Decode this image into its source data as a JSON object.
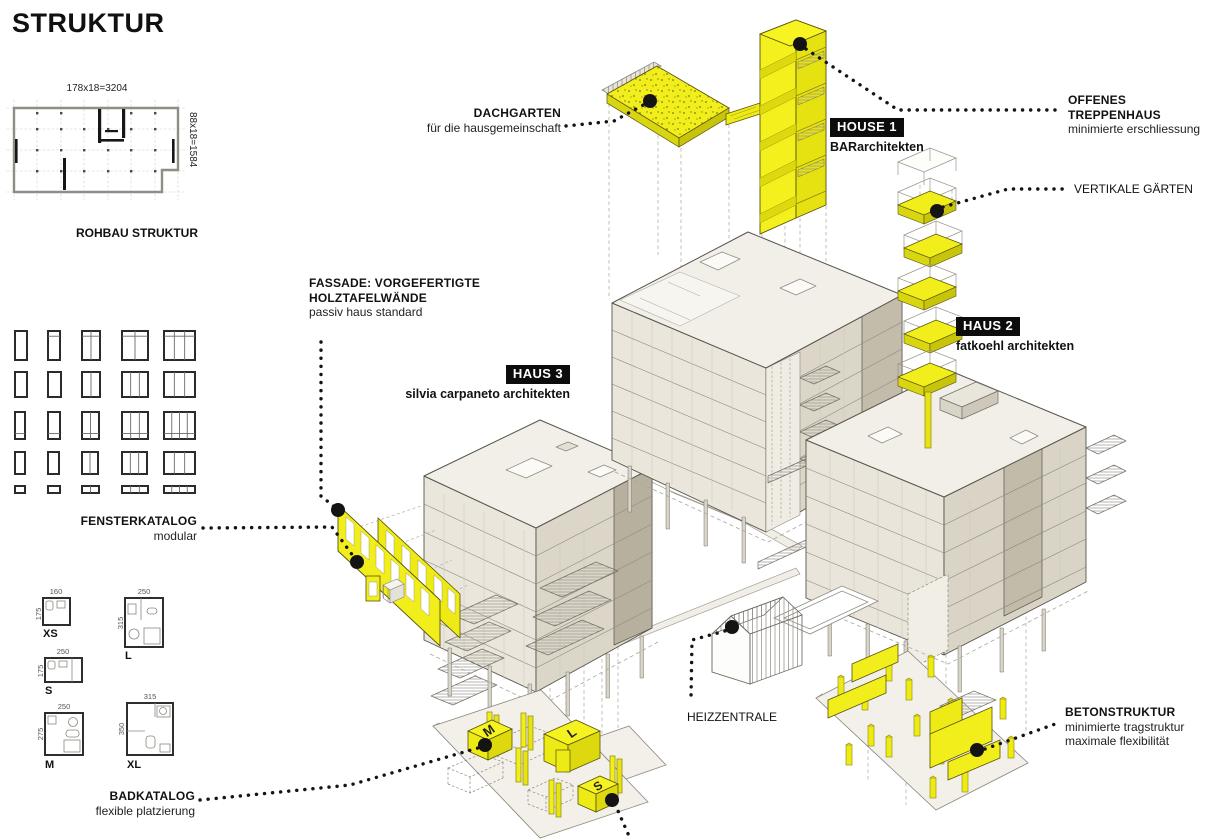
{
  "title": "STRUKTUR",
  "colors": {
    "accent_yellow": "#f2ee1c",
    "accent_yellow_dark": "#d9d510",
    "roof_light": "#f1efe7",
    "face_light": "#eae6db",
    "face_mid": "#dbd6c8",
    "face_dark": "#bdb5a4",
    "line_dark": "#56544c",
    "leader_black": "#141414"
  },
  "rohbau": {
    "label": "ROHBAU STRUKTUR",
    "dim_horizontal": "178x18=3204",
    "dim_vertical": "88x18=1584"
  },
  "fensterkatalog": {
    "label": "FENSTERKATALOG",
    "sublabel": "modular",
    "grid": {
      "rows": [
        {
          "y": 331,
          "h": 29,
          "cells": [
            {
              "x": 15,
              "w": 12
            },
            {
              "x": 48,
              "w": 12,
              "tr": "top"
            },
            {
              "x": 82,
              "w": 18,
              "m": 1,
              "tr": "top"
            },
            {
              "x": 122,
              "w": 26,
              "m": 1,
              "tr": "top"
            },
            {
              "x": 164,
              "w": 31,
              "m": 2,
              "tr": "top"
            }
          ]
        },
        {
          "y": 372,
          "h": 25,
          "cells": [
            {
              "x": 15,
              "w": 12
            },
            {
              "x": 48,
              "w": 13
            },
            {
              "x": 82,
              "w": 18,
              "m": 1
            },
            {
              "x": 122,
              "w": 26,
              "m": 2
            },
            {
              "x": 164,
              "w": 31,
              "m": 2
            }
          ]
        },
        {
          "y": 412,
          "h": 27,
          "cells": [
            {
              "x": 15,
              "w": 10,
              "tr": "bottom"
            },
            {
              "x": 48,
              "w": 12,
              "tr": "bottom"
            },
            {
              "x": 82,
              "w": 17,
              "m": 1,
              "tr": "bottom"
            },
            {
              "x": 122,
              "w": 26,
              "m": 2,
              "tr": "bottom"
            },
            {
              "x": 164,
              "w": 31,
              "m": 3,
              "tr": "bottom"
            }
          ]
        },
        {
          "y": 452,
          "h": 22,
          "cells": [
            {
              "x": 15,
              "w": 10
            },
            {
              "x": 48,
              "w": 11
            },
            {
              "x": 82,
              "w": 16,
              "m": 1
            },
            {
              "x": 122,
              "w": 25,
              "m": 2
            },
            {
              "x": 164,
              "w": 31,
              "m": 2
            }
          ]
        },
        {
          "y": 486,
          "h": 7,
          "cells": [
            {
              "x": 15,
              "w": 10
            },
            {
              "x": 48,
              "w": 12
            },
            {
              "x": 82,
              "w": 17,
              "m": 1
            },
            {
              "x": 122,
              "w": 26,
              "m": 2
            },
            {
              "x": 164,
              "w": 31,
              "m": 3
            }
          ]
        }
      ]
    }
  },
  "badkatalog": {
    "label": "BADKATALOG",
    "sublabel": "flexible platzierung",
    "items": [
      {
        "name": "XS",
        "width": "160",
        "height": "175"
      },
      {
        "name": "S",
        "width": "250",
        "height": "175"
      },
      {
        "name": "M",
        "width": "250",
        "height": "275"
      },
      {
        "name": "L",
        "width": "250",
        "height": "315"
      },
      {
        "name": "XL",
        "width": "315",
        "height": "350"
      }
    ]
  },
  "modules": {
    "m": "M",
    "l": "L",
    "s": "S"
  },
  "buildings": {
    "house1": {
      "tag": "HOUSE 1",
      "architect": "BARarchitekten"
    },
    "haus2": {
      "tag": "HAUS 2",
      "architect": "fatkoehl architekten"
    },
    "haus3": {
      "tag": "HAUS 3",
      "architect": "silvia carpaneto architekten"
    }
  },
  "annotations": {
    "dachgarten": {
      "title": "DACHGARTEN",
      "subtitle": "für die hausgemeinschaft"
    },
    "offenes_treppenhaus": {
      "line1": "OFFENES",
      "line2": "TREPPENHAUS",
      "subtitle": "minimierte erschliessung"
    },
    "vertikale_gaerten": {
      "title": "VERTIKALE GÄRTEN"
    },
    "fassade": {
      "line1": "FASSADE: VORGEFERTIGTE",
      "line2": "HOLZTAFELWÄNDE",
      "subtitle": "passiv haus standard"
    },
    "heizzentrale": {
      "title": "HEIZZENTRALE"
    },
    "betonstruktur": {
      "title": "BETONSTRUKTUR",
      "sub1": "minimierte tragstruktur",
      "sub2": "maximale flexibilität"
    }
  }
}
